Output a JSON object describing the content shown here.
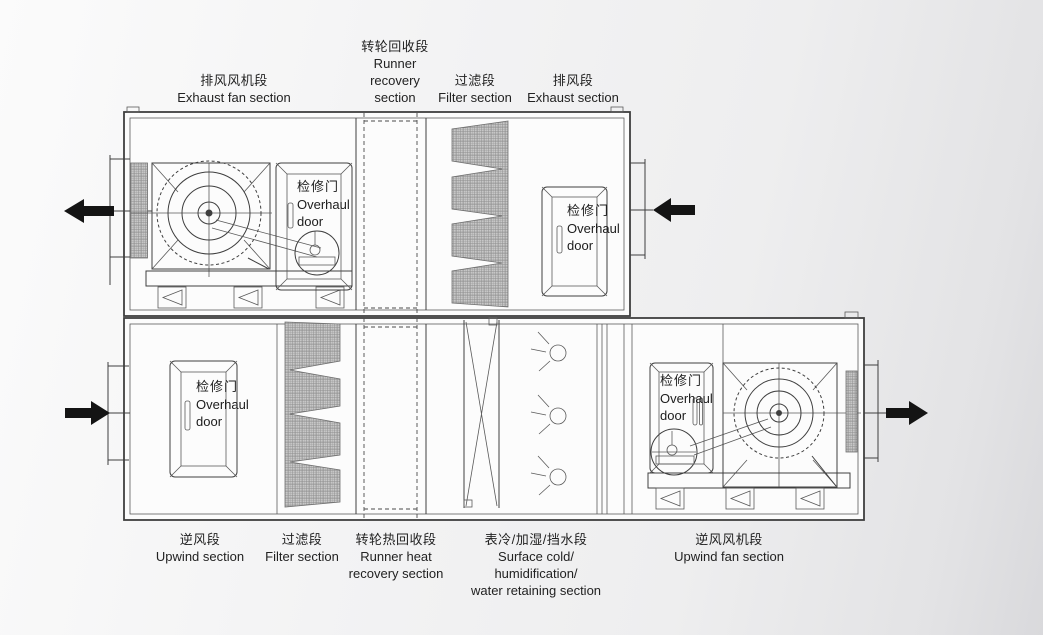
{
  "sections": {
    "top": [
      {
        "zh": "排风风机段",
        "en": "Exhaust fan section"
      },
      {
        "zh": "转轮回收段",
        "en": "Runner\nrecovery\nsection"
      },
      {
        "zh": "过滤段",
        "en": "Filter section"
      },
      {
        "zh": "排风段",
        "en": "Exhaust section"
      }
    ],
    "bottom": [
      {
        "zh": "逆风段",
        "en": "Upwind section"
      },
      {
        "zh": "过滤段",
        "en": "Filter section"
      },
      {
        "zh": "转轮热回收段",
        "en": "Runner heat\nrecovery section"
      },
      {
        "zh": "表冷/加湿/挡水段",
        "en": "Surface cold/\nhumidification/\nwater retaining section"
      },
      {
        "zh": "逆风风机段",
        "en": "Upwind fan section"
      }
    ]
  },
  "doors": [
    {
      "zh": "检修门",
      "en": "Overhaul\ndoor"
    },
    {
      "zh": "检修门",
      "en": "Overhaul\ndoor"
    },
    {
      "zh": "检修门",
      "en": "Overhaul\ndoor"
    },
    {
      "zh": "检修门",
      "en": "Overhaul\ndoor"
    }
  ],
  "airflow_arrows": [
    {
      "name": "exhaust-outlet-arrow",
      "direction": "left"
    },
    {
      "name": "exhaust-inlet-arrow",
      "direction": "left"
    },
    {
      "name": "supply-inlet-arrow",
      "direction": "right"
    },
    {
      "name": "supply-outlet-arrow",
      "direction": "right"
    }
  ],
  "colors": {
    "background": "#efeff0",
    "panel": "#fcfcfc",
    "line": "#3f3f3f",
    "arrow": "#141414",
    "text": "#222222",
    "hatch_fill": "#c7c7c7",
    "hatch_line": "#8d8d8d"
  }
}
